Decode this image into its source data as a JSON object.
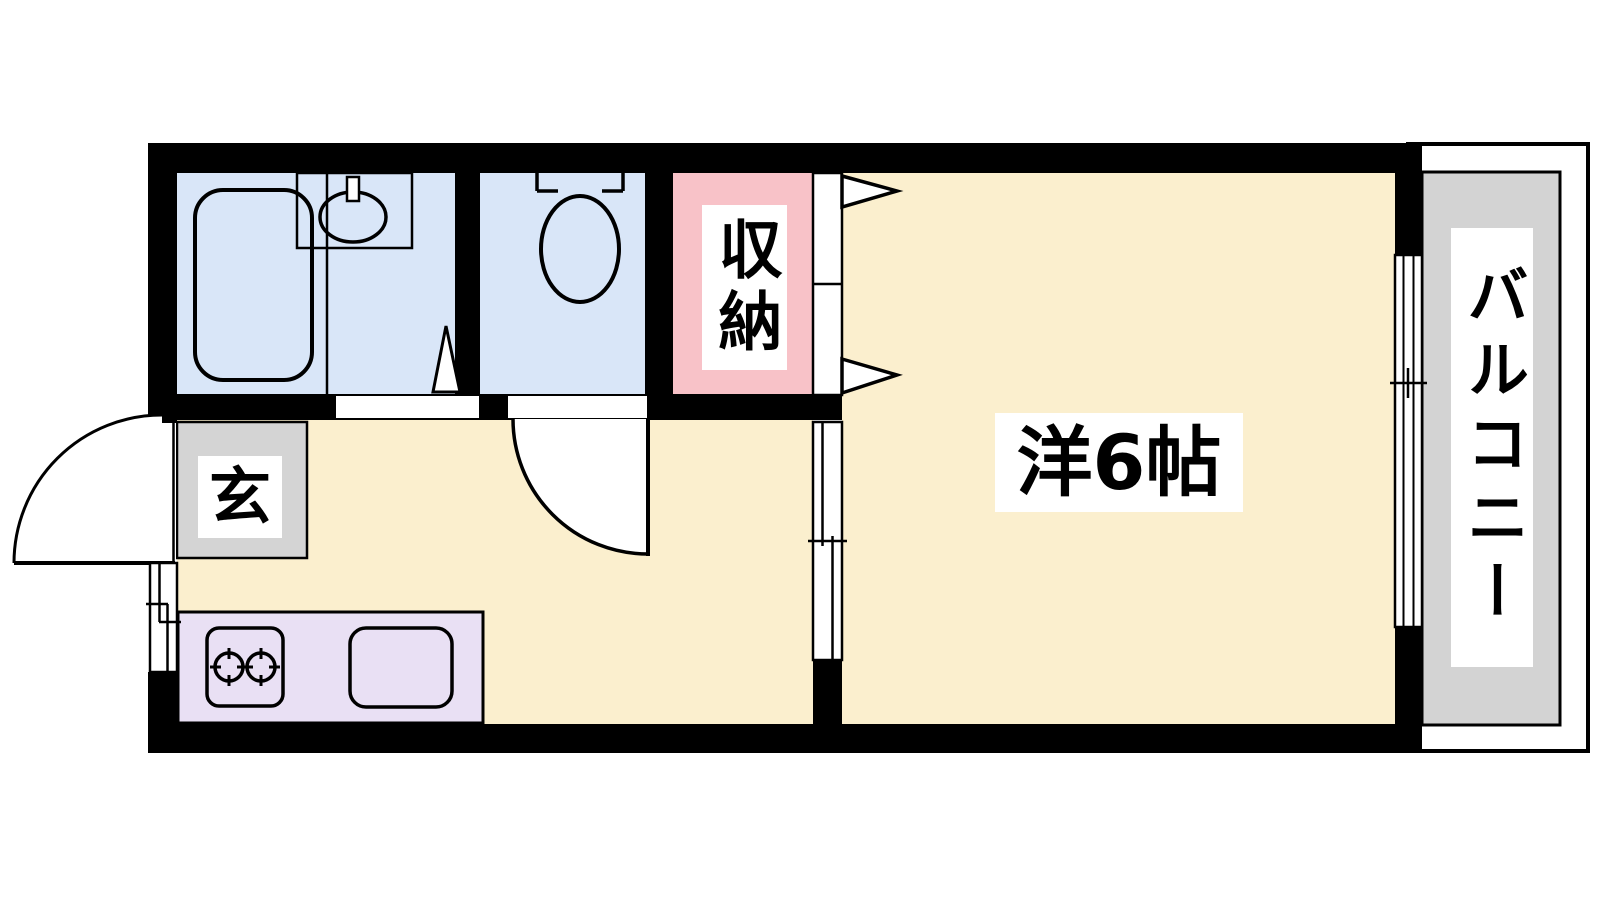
{
  "plan": {
    "type": "apartment-floor-plan",
    "labels": {
      "entrance": "玄",
      "storage": "収納",
      "western_room": "洋6帖",
      "balcony": "バルコニー"
    },
    "colors": {
      "wall": "#000000",
      "outline": "#000000",
      "wet_area": "#D9E6F8",
      "storage": "#F8C2C8",
      "floor": "#FBEFCE",
      "kitchen_counter": "#E9E0F4",
      "entrance_mat": "#D4D4D4",
      "balcony_deck": "#D3D3D3",
      "label_bg": "#FFFFFF",
      "open_area": "#FFFFFF"
    }
  }
}
